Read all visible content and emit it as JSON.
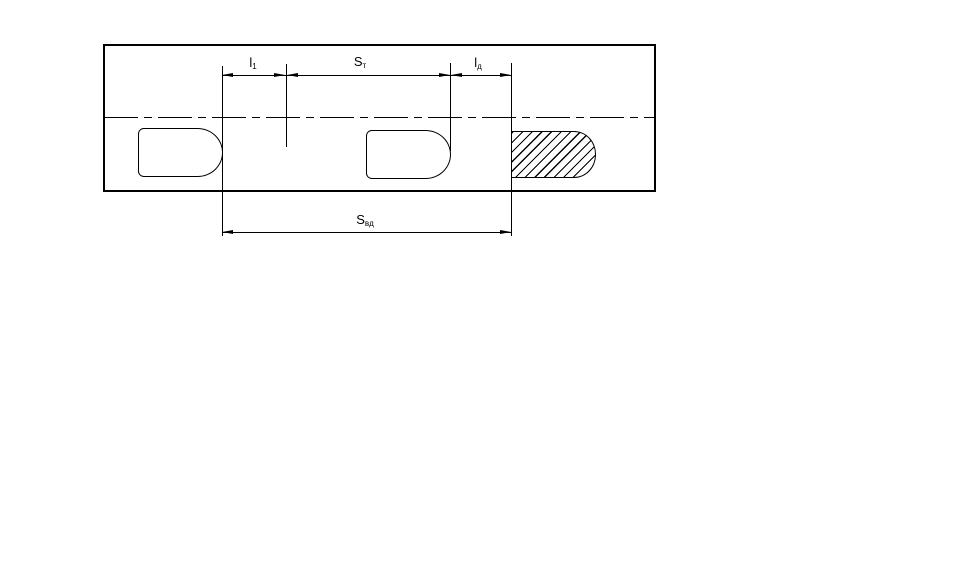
{
  "figure": {
    "type": "engineering-dimension-drawing",
    "colors": {
      "background": "#ffffff",
      "line": "#000000"
    },
    "labels": {
      "l1": {
        "base": "l",
        "sub": "1"
      },
      "st": {
        "base": "S",
        "sub": "т"
      },
      "ld": {
        "base": "l",
        "sub": "д"
      },
      "svd": {
        "base": "S",
        "sub": "вд"
      }
    }
  }
}
